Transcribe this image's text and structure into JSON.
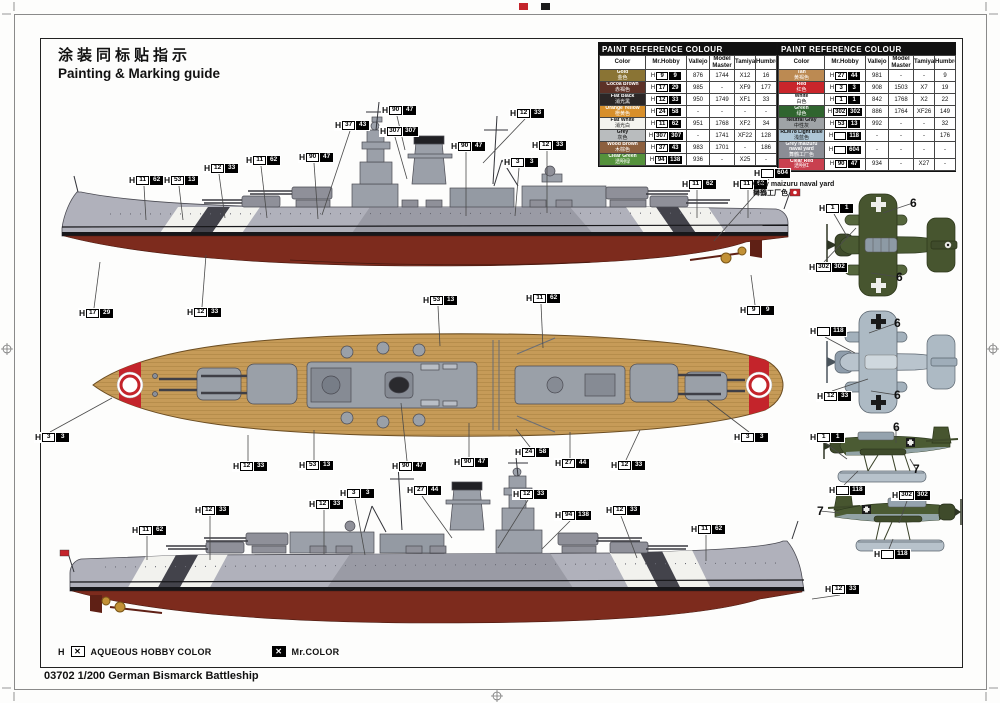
{
  "title": {
    "zh": "涂装同标贴指示",
    "en": "Painting & Marking guide"
  },
  "caption": "03702 1/200 German Bismarck Battleship",
  "legend": {
    "h": "H",
    "mark": "✕",
    "aqueous": "AQUEOUS HOBBY COLOR",
    "mrcolor": "Mr.COLOR"
  },
  "note": {
    "h": "",
    "c": "604",
    "line1": "Grey maizuru naval yard",
    "line2": "舞鶴工厂色"
  },
  "accent_colors": {
    "hull_red": "#7d2b1d",
    "deck_tan": "#c69b58",
    "hull_grey": "#b0b1bb",
    "plane_green": "#4b5b33",
    "plane_light_blue": "#b7c2cb"
  },
  "tables": [
    {
      "title": "PAINT  REFERENCE  COLOUR",
      "columns": [
        "Color",
        "Mr.Hobby",
        "Vallejo",
        "Model Master",
        "Tamiya",
        "Humbrol"
      ],
      "rows": [
        {
          "name": "Gold",
          "zh": "金色",
          "swatch": "#8a7434",
          "tc": "#fff",
          "h": "9",
          "c": "9",
          "vallejo": "876",
          "mm": "1744",
          "tamiya": "X12",
          "humbrol": "16"
        },
        {
          "name": "Cocoa Brown",
          "zh": "赤褐色",
          "swatch": "#5c3127",
          "tc": "#fff",
          "h": "17",
          "c": "29",
          "vallejo": "985",
          "mm": "-",
          "tamiya": "XF9",
          "humbrol": "177"
        },
        {
          "name": "Flat Black",
          "zh": "消光黑",
          "swatch": "#2b2626",
          "tc": "#fff",
          "h": "12",
          "c": "33",
          "vallejo": "950",
          "mm": "1749",
          "tamiya": "XF1",
          "humbrol": "33"
        },
        {
          "name": "Orange Yellow",
          "zh": "橙黄色",
          "swatch": "#d78f2b",
          "tc": "#fff",
          "h": "24",
          "c": "58",
          "vallejo": "-",
          "mm": "-",
          "tamiya": "-",
          "humbrol": "-"
        },
        {
          "name": "Flat White",
          "zh": "消光白",
          "swatch": "#f4f4ef",
          "tc": "#111",
          "h": "11",
          "c": "62",
          "vallejo": "951",
          "mm": "1768",
          "tamiya": "XF2",
          "humbrol": "34"
        },
        {
          "name": "Grey",
          "zh": "灰色",
          "swatch": "#b9bcbe",
          "tc": "#111",
          "h": "307",
          "c": "307",
          "vallejo": "-",
          "mm": "1741",
          "tamiya": "XF22",
          "humbrol": "128"
        },
        {
          "name": "Wood Brown",
          "zh": "木棕色",
          "swatch": "#8c5f3e",
          "tc": "#fff",
          "h": "37",
          "c": "43",
          "vallejo": "983",
          "mm": "1701",
          "tamiya": "-",
          "humbrol": "186"
        },
        {
          "name": "Clear Green",
          "zh": "透明绿",
          "swatch": "#55923c",
          "tc": "#fff",
          "h": "94",
          "c": "138",
          "vallejo": "936",
          "mm": "-",
          "tamiya": "X25",
          "humbrol": "-"
        }
      ]
    },
    {
      "title": "PAINT  REFERENCE  COLOUR",
      "columns": [
        "Color",
        "Mr.Hobby",
        "Vallejo",
        "Model Master",
        "Tamiya",
        "Humbrol"
      ],
      "rows": [
        {
          "name": "Tan",
          "zh": "黄褐色",
          "swatch": "#bc8a52",
          "tc": "#fff",
          "h": "27",
          "c": "44",
          "vallejo": "981",
          "mm": "-",
          "tamiya": "-",
          "humbrol": "9"
        },
        {
          "name": "Red",
          "zh": "红色",
          "swatch": "#c9252b",
          "tc": "#fff",
          "h": "3",
          "c": "3",
          "vallejo": "908",
          "mm": "1503",
          "tamiya": "X7",
          "humbrol": "19"
        },
        {
          "name": "White",
          "zh": "白色",
          "swatch": "#ffffff",
          "tc": "#111",
          "h": "1",
          "c": "1",
          "vallejo": "842",
          "mm": "1768",
          "tamiya": "X2",
          "humbrol": "22"
        },
        {
          "name": "Green",
          "zh": "绿色",
          "swatch": "#30652f",
          "tc": "#fff",
          "h": "302",
          "c": "302",
          "vallejo": "886",
          "mm": "1764",
          "tamiya": "XF26",
          "humbrol": "149"
        },
        {
          "name": "Neutral Gray",
          "zh": "中性灰",
          "swatch": "#9fa3a6",
          "tc": "#111",
          "h": "53",
          "c": "13",
          "vallejo": "992",
          "mm": "-",
          "tamiya": "-",
          "humbrol": "32"
        },
        {
          "name": "RLM78 Light Blue",
          "zh": "浅蓝色",
          "swatch": "#aec6d6",
          "tc": "#111",
          "h": "",
          "c": "118",
          "vallejo": "-",
          "mm": "-",
          "tamiya": "-",
          "humbrol": "176"
        },
        {
          "name": "Grey maizuru naval yard",
          "zh": "舞鶴工厂色",
          "swatch": "#8b8d95",
          "tc": "#fff",
          "h": "",
          "c": "604",
          "vallejo": "-",
          "mm": "-",
          "tamiya": "-",
          "humbrol": "-"
        },
        {
          "name": "Clear Red",
          "zh": "透明红",
          "swatch": "#c9404f",
          "tc": "#fff",
          "h": "90",
          "c": "47",
          "vallejo": "934",
          "mm": "-",
          "tamiya": "X27",
          "humbrol": "-"
        }
      ]
    }
  ],
  "callouts": [
    {
      "h": "37",
      "c": "43",
      "x": 334,
      "y": 120,
      "lx": -28,
      "ld": 84
    },
    {
      "h": "90",
      "c": "47",
      "x": 381,
      "y": 105,
      "lx": 8,
      "ld": 34
    },
    {
      "h": "307",
      "c": "307",
      "x": 379,
      "y": 126,
      "lx": 12,
      "ld": 42
    },
    {
      "h": "12",
      "c": "33",
      "x": 509,
      "y": 108,
      "lx": -42,
      "ld": 44
    },
    {
      "h": "12",
      "c": "33",
      "x": 203,
      "y": 163,
      "lx": 6,
      "ld": 44
    },
    {
      "h": "11",
      "c": "62",
      "x": 245,
      "y": 155,
      "lx": 6,
      "ld": 52
    },
    {
      "h": "90",
      "c": "47",
      "x": 298,
      "y": 152,
      "lx": 4,
      "ld": 56
    },
    {
      "h": "90",
      "c": "47",
      "x": 450,
      "y": 141,
      "lx": 0,
      "ld": 64
    },
    {
      "h": "12",
      "c": "33",
      "x": 531,
      "y": 140,
      "lx": 0,
      "ld": 62
    },
    {
      "h": "3",
      "c": "3",
      "x": 503,
      "y": 157,
      "lx": -4,
      "ld": 48
    },
    {
      "h": "53",
      "c": "13",
      "x": 163,
      "y": 175,
      "lx": 4,
      "ld": 34
    },
    {
      "h": "11",
      "c": "62",
      "x": 128,
      "y": 175,
      "lx": 2,
      "ld": 34
    },
    {
      "h": "11",
      "c": "62",
      "x": 681,
      "y": 179,
      "lx": 0,
      "ld": 28
    },
    {
      "h": "11",
      "c": "62",
      "x": 732,
      "y": 179,
      "lx": 0,
      "ld": 28
    },
    {
      "h": "17",
      "c": "29",
      "x": 78,
      "y": 308,
      "lx": 6,
      "ld": -46
    },
    {
      "h": "12",
      "c": "33",
      "x": 186,
      "y": 307,
      "lx": 4,
      "ld": -52
    },
    {
      "h": "9",
      "c": "9",
      "x": 739,
      "y": 305,
      "lx": -4,
      "ld": -30
    },
    {
      "h": "53",
      "c": "13",
      "x": 422,
      "y": 295,
      "lx": 2,
      "ld": 40
    },
    {
      "h": "11",
      "c": "62",
      "x": 525,
      "y": 293,
      "lx": 2,
      "ld": 44
    },
    {
      "h": "3",
      "c": "3",
      "x": 34,
      "y": 432,
      "lx": 62,
      "ld": -34
    },
    {
      "h": "3",
      "c": "3",
      "x": 733,
      "y": 432,
      "lx": -42,
      "ld": -32
    },
    {
      "h": "12",
      "c": "33",
      "x": 232,
      "y": 461,
      "lx": 0,
      "ld": -26
    },
    {
      "h": "53",
      "c": "13",
      "x": 298,
      "y": 460,
      "lx": 0,
      "ld": -30
    },
    {
      "h": "90",
      "c": "47",
      "x": 391,
      "y": 461,
      "lx": -6,
      "ld": -58
    },
    {
      "h": "90",
      "c": "47",
      "x": 453,
      "y": 457,
      "lx": 0,
      "ld": -34
    },
    {
      "h": "24",
      "c": "58",
      "x": 514,
      "y": 447,
      "lx": -14,
      "ld": -18
    },
    {
      "h": "27",
      "c": "44",
      "x": 554,
      "y": 458,
      "lx": 0,
      "ld": -26
    },
    {
      "h": "12",
      "c": "33",
      "x": 610,
      "y": 460,
      "lx": 14,
      "ld": -30
    },
    {
      "h": "27",
      "c": "44",
      "x": 406,
      "y": 485,
      "lx": 30,
      "ld": 42
    },
    {
      "h": "12",
      "c": "33",
      "x": 308,
      "y": 499,
      "lx": 0,
      "ld": 44
    },
    {
      "h": "3",
      "c": "3",
      "x": 339,
      "y": 488,
      "lx": 10,
      "ld": 56
    },
    {
      "h": "12",
      "c": "33",
      "x": 512,
      "y": 489,
      "lx": -30,
      "ld": 48
    },
    {
      "h": "94",
      "c": "138",
      "x": 554,
      "y": 510,
      "lx": -28,
      "ld": 28
    },
    {
      "h": "12",
      "c": "33",
      "x": 605,
      "y": 505,
      "lx": 16,
      "ld": 42
    },
    {
      "h": "11",
      "c": "62",
      "x": 690,
      "y": 524,
      "lx": 0,
      "ld": 26
    },
    {
      "h": "12",
      "c": "33",
      "x": 194,
      "y": 505,
      "lx": 0,
      "ld": 44
    },
    {
      "h": "11",
      "c": "62",
      "x": 131,
      "y": 525,
      "lx": 0,
      "ld": 24
    },
    {
      "h": "12",
      "c": "33",
      "x": 824,
      "y": 584,
      "lx": -28,
      "ld": 4
    },
    {
      "h": "1",
      "c": "1",
      "x": 818,
      "y": 203,
      "lx": 14,
      "ld": 24
    },
    {
      "h": "302",
      "c": "302",
      "x": 808,
      "y": 262,
      "lx": 32,
      "ld": -34
    },
    {
      "h": "",
      "c": "118",
      "x": 809,
      "y": 326,
      "lx": 30,
      "ld": 16
    },
    {
      "h": "12",
      "c": "33",
      "x": 816,
      "y": 391,
      "lx": 36,
      "ld": -12
    },
    {
      "h": "1",
      "c": "1",
      "x": 809,
      "y": 432,
      "lx": 22,
      "ld": 16
    },
    {
      "h": "",
      "c": "118",
      "x": 828,
      "y": 485,
      "lx": 14,
      "ld": -14
    },
    {
      "h": "302",
      "c": "302",
      "x": 891,
      "y": 490,
      "lx": -8,
      "ld": 22
    },
    {
      "h": "",
      "c": "118",
      "x": 873,
      "y": 549,
      "lx": 4,
      "ld": -10
    },
    {
      "h": "",
      "c": "604",
      "x": 753,
      "y": 168,
      "lx": -55,
      "ld": 62
    }
  ],
  "decal_labels": [
    {
      "t": "6",
      "x": 910,
      "y": 196,
      "lx": -30,
      "ld": 10
    },
    {
      "t": "6",
      "x": 896,
      "y": 270,
      "lx": -28,
      "ld": -4
    },
    {
      "t": "6",
      "x": 894,
      "y": 316,
      "lx": -28,
      "ld": 10
    },
    {
      "t": "6",
      "x": 894,
      "y": 388,
      "lx": -26,
      "ld": -4
    },
    {
      "t": "6",
      "x": 893,
      "y": 420,
      "lx": 0,
      "ld": 16
    },
    {
      "t": "7",
      "x": 913,
      "y": 462,
      "lx": -6,
      "ld": -10
    },
    {
      "t": "7",
      "x": 817,
      "y": 504,
      "lx": 20,
      "ld": 2
    }
  ]
}
